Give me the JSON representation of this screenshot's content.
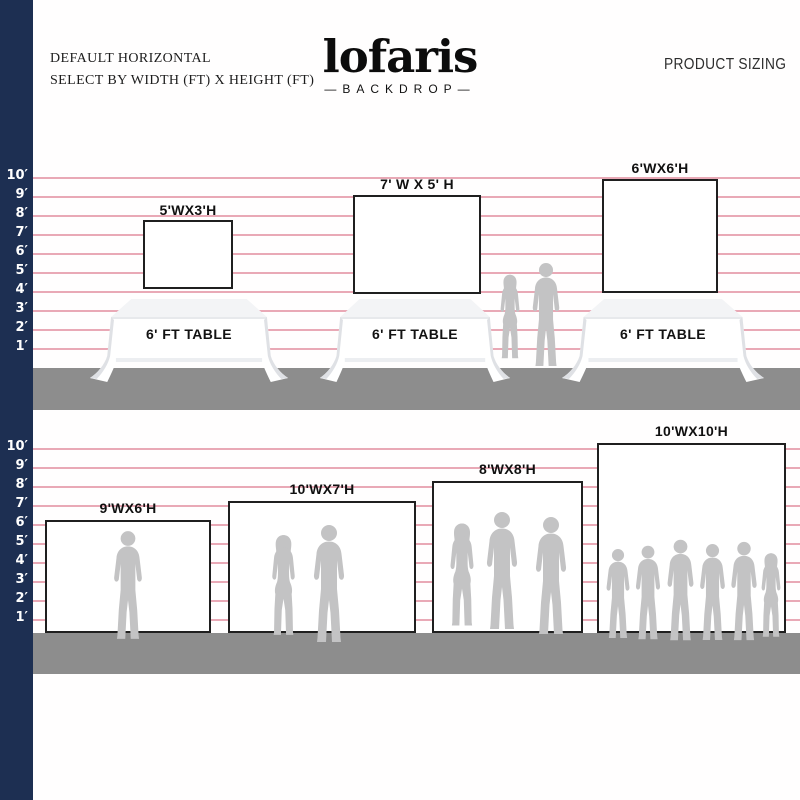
{
  "header": {
    "line1": "DEFAULT HORIZONTAL",
    "line2": "SELECT BY WIDTH (FT) X HEIGHT (FT)",
    "product_sizing": "PRODUCT SIZING"
  },
  "brand": {
    "name": "lofaris",
    "tagline": "—BACKDROP—"
  },
  "ruler": {
    "unit": "feet",
    "labels": [
      "10′",
      "9′",
      "8′",
      "7′",
      "6′",
      "5′",
      "4′",
      "3′",
      "2′",
      "1′"
    ]
  },
  "upper_row": {
    "backdrops": [
      {
        "label": "5'WX3'H",
        "width_ft": 5,
        "height_ft": 3
      },
      {
        "label": "7' W X 5' H",
        "width_ft": 7,
        "height_ft": 5
      },
      {
        "label": "6'WX6'H",
        "width_ft": 6,
        "height_ft": 6
      }
    ],
    "tables": [
      {
        "label": "6' FT TABLE"
      },
      {
        "label": "6' FT TABLE"
      },
      {
        "label": "6' FT TABLE"
      }
    ],
    "people_count": 2
  },
  "lower_row": {
    "backdrops": [
      {
        "label": "9'WX6'H",
        "width_ft": 9,
        "height_ft": 6,
        "people_count": 1
      },
      {
        "label": "10'WX7'H",
        "width_ft": 10,
        "height_ft": 7,
        "people_count": 2
      },
      {
        "label": "8'WX8'H",
        "width_ft": 8,
        "height_ft": 8,
        "people_count": 3
      },
      {
        "label": "10'WX10'H",
        "width_ft": 10,
        "height_ft": 10,
        "people_count": 6
      }
    ]
  },
  "colors": {
    "navy": "#1d2f52",
    "pink_line": "#e9a9b6",
    "floor_gray": "#8d8d8d",
    "silhouette_gray": "#c3c3c4"
  }
}
